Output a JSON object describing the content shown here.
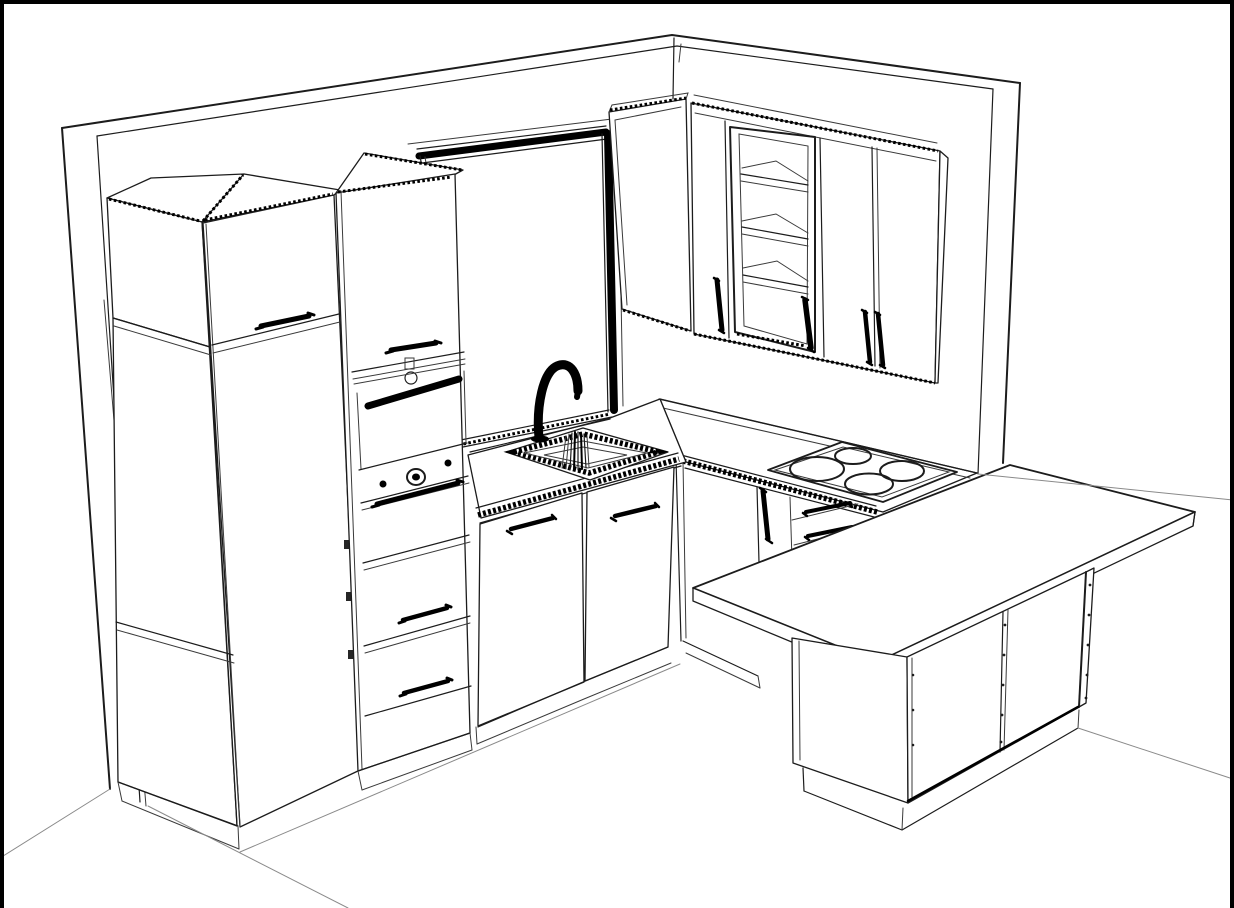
{
  "scene": {
    "description": "Black-and-white 3D line-art rendering of a kitchen: tall cabinet block with built-in oven and drawers, window over a corner sink with gooseneck faucet, wall cabinets including one glass door with shelves, four-burner cooktop on the right counter, and a breakfast-bar peninsula with an island base cabinet.",
    "style": "monochrome CAD line drawing",
    "background_color": "#ffffff",
    "line_color": "#1c1c1c",
    "accent_black": "#000000",
    "floor_line_color": "#8a8a8a",
    "burner_count": 4,
    "glass_cabinet_shelves": 3,
    "right_wall_cabinet_doors": 4,
    "island_doors": 2,
    "oven_tower_drawers": 3,
    "sink_base_doors": 2,
    "border_sides": [
      "top",
      "left",
      "right"
    ]
  }
}
